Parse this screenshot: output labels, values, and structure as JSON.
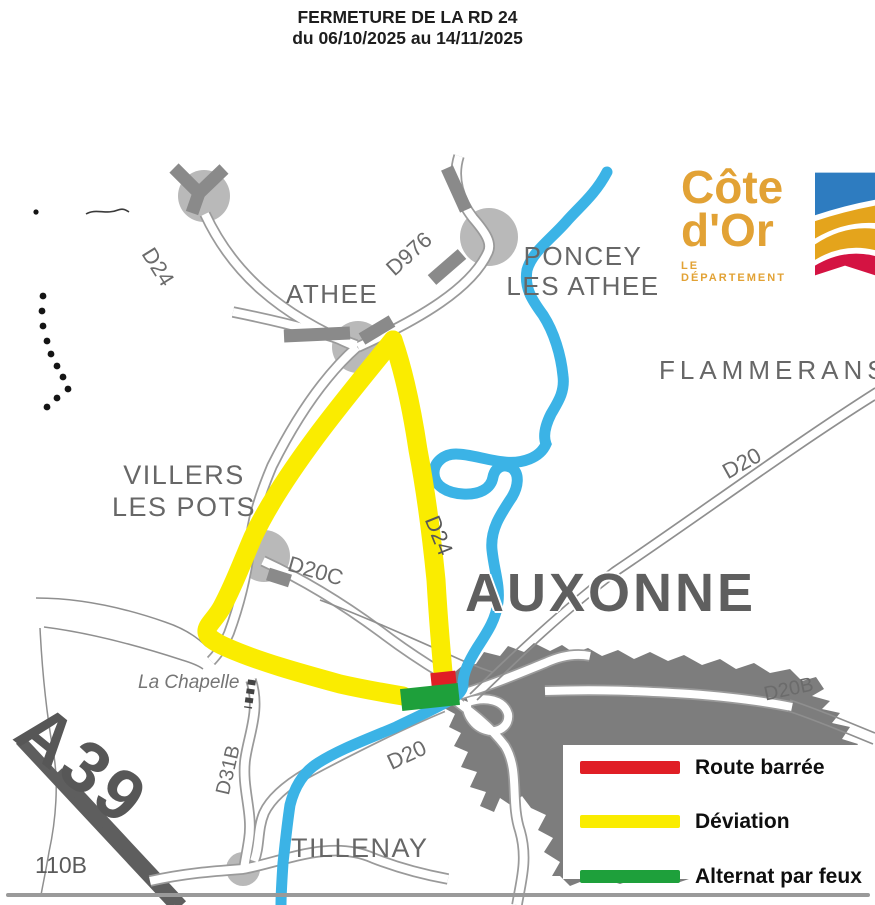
{
  "title": {
    "line1": "FERMETURE DE LA RD 24",
    "line2": "du 06/10/2025 au 14/11/2025"
  },
  "logo": {
    "line1": "Côte",
    "line2": "d'Or",
    "subtitle": "LE DÉPARTEMENT"
  },
  "map": {
    "towns": {
      "athee": "ATHEE",
      "poncey_line1": "PONCEY",
      "poncey_line2": "LES ATHEE",
      "flammerans": "FLAMMERANS",
      "villers_line1": "VILLERS",
      "villers_line2": "LES POTS",
      "auxonne": "AUXONNE",
      "tillenay": "TILLENAY",
      "la_chapelle": "La Chapelle"
    },
    "roads": {
      "d24_nw": "D24",
      "d976": "D976",
      "d24_mid": "D24",
      "d20c": "D20C",
      "d20_ne": "D20",
      "d20_sw": "D20",
      "d20b": "D20B",
      "d31b": "D31B",
      "a39": "A39",
      "d110b": "110B"
    }
  },
  "legend": {
    "items": [
      {
        "label": "Route barrée",
        "color": "#E01E25"
      },
      {
        "label": "Déviation",
        "color": "#FAEC00"
      },
      {
        "label": "Alternat par feux",
        "color": "#1EA03B"
      }
    ]
  },
  "colors": {
    "deviation": "#FAEC00",
    "route_barree": "#E01E25",
    "alternat_par_feux": "#1EA03B",
    "river": "#3BB3E6",
    "urban_area": "#7d7d7d",
    "road_casing": "#9a9a9a",
    "road_dark": "#8a8a8a",
    "motorway": "#5e5e5e",
    "town_circle": "#b9b9b9",
    "logo_gold": "#E2A235",
    "flag_blue": "#2E7CC0",
    "flag_gold": "#E4A41C",
    "flag_red": "#D41342"
  }
}
